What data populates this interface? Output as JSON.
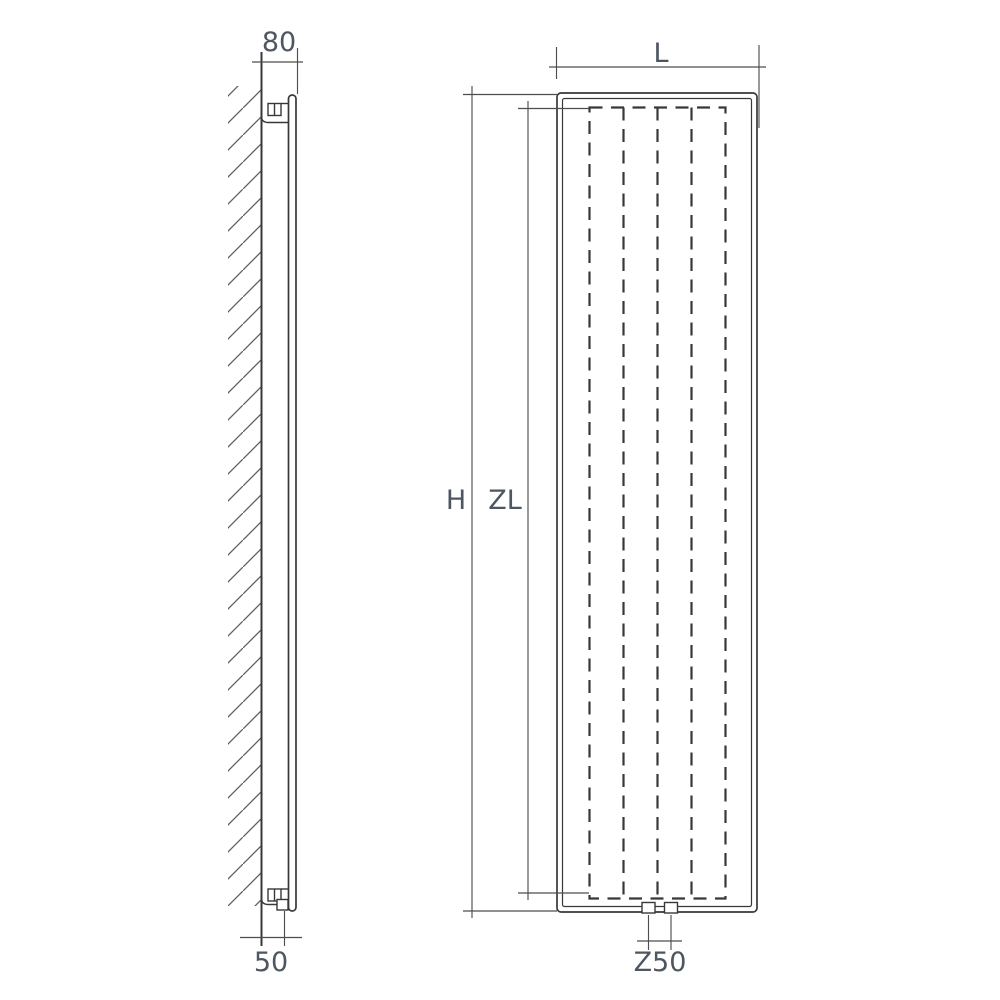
{
  "drawing_title": "Vertical radiator technical dimension drawing (side view and front view)",
  "colors": {
    "background": "#ffffff",
    "line": "#383838",
    "dim_line": "#4e4e4e",
    "hatch": "#5e5e5e",
    "label": "#4d5661"
  },
  "side_view": {
    "dim_top_wall_offset": "80",
    "dim_bottom_wall_offset": "50"
  },
  "front_view": {
    "dim_width": "L",
    "dim_overall_height": "H",
    "dim_element_height": "ZL",
    "dim_connection_spacing": "Z50"
  }
}
